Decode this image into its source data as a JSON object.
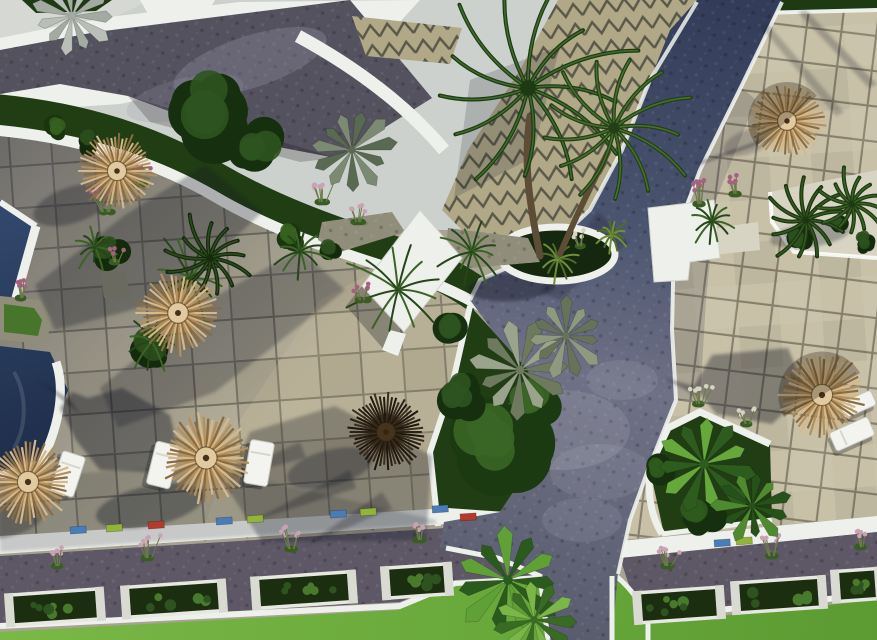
{
  "canvas": {
    "w": 877,
    "h": 640
  },
  "palette": {
    "sky": "#cdd1ce",
    "white": "#eef0ec",
    "paving": "#55525f",
    "zigzag_base": "#b1a888",
    "tile_left": "#b0aa94",
    "tile_right": "#c8c1a8",
    "grout_left": "#4b4840",
    "grout_right": "#5a5444",
    "pool_light": "#33496e",
    "pool_deep": "#1c2b47",
    "lawn_light": "#7ab847",
    "lawn_deep": "#5c9b32",
    "garden": "#203d14",
    "hedge": "#1d3a13",
    "stone": "#908d7a",
    "gravel": "#d7d4c4",
    "trunk": "#5e4d36",
    "path_top": "#333d59",
    "path_mid": "#4a546f",
    "path_junction": "#6f7186",
    "path_low": "#585c6d",
    "walkway": "#5e5866",
    "straw": [
      "#d6b88a",
      "#b3905c",
      "#8a6b40"
    ],
    "straw_center": "#e2c99e",
    "dark_straw": [
      "#2c2214",
      "#1d1710",
      "#3b2d1b"
    ],
    "dark_center": "#45331e",
    "accent_blue": "#4a7db8",
    "accent_lime": "#93b43a",
    "accent_red": "#b53a2e",
    "pink": "#c9a3b4",
    "magenta": "#a85f84",
    "plume": "#d8d4c2",
    "shadow_rgb": "22,25,38"
  },
  "umbrellas": [
    {
      "cx": 117,
      "cy": 171,
      "r": 40,
      "type": "straw"
    },
    {
      "cx": 178,
      "cy": 313,
      "r": 43,
      "type": "straw"
    },
    {
      "cx": 28,
      "cy": 482,
      "r": 44,
      "type": "straw"
    },
    {
      "cx": 206,
      "cy": 458,
      "r": 46,
      "type": "straw"
    },
    {
      "cx": 386,
      "cy": 432,
      "r": 40,
      "type": "dark"
    },
    {
      "cx": 787,
      "cy": 121,
      "r": 39,
      "type": "straw",
      "shade": 140
    },
    {
      "cx": 822,
      "cy": 395,
      "r": 44,
      "type": "straw",
      "shade": 150
    }
  ],
  "umbrella_shadows": [
    {
      "cx": 72,
      "cy": 205,
      "rx": 40,
      "ry": 18,
      "rot": -18,
      "o": 0.32
    },
    {
      "cx": 2,
      "cy": 522,
      "rx": 42,
      "ry": 16,
      "rot": -12,
      "o": 0.32
    },
    {
      "cx": 150,
      "cy": 506,
      "rx": 55,
      "ry": 20,
      "rot": -12,
      "o": 0.38
    },
    {
      "cx": 330,
      "cy": 468,
      "rx": 44,
      "ry": 18,
      "rot": -15,
      "o": 0.33
    },
    {
      "cx": 748,
      "cy": 142,
      "rx": 26,
      "ry": 12,
      "rot": -20,
      "o": 0.22
    },
    {
      "cx": 810,
      "cy": 235,
      "rx": 40,
      "ry": 12,
      "rot": -8,
      "o": 0.3
    },
    {
      "cx": 512,
      "cy": 287,
      "rx": 44,
      "ry": 14,
      "rot": -4,
      "o": 0.42
    }
  ],
  "loungers": [
    {
      "cx": 68,
      "cy": 474,
      "w": 24,
      "h": 42,
      "rot": 18
    },
    {
      "cx": 163,
      "cy": 465,
      "w": 24,
      "h": 44,
      "rot": 14
    },
    {
      "cx": 259,
      "cy": 463,
      "w": 24,
      "h": 44,
      "rot": 10
    },
    {
      "cx": 852,
      "cy": 434,
      "w": 42,
      "h": 20,
      "rot": -24
    },
    {
      "cx": 858,
      "cy": 404,
      "w": 34,
      "h": 16,
      "rot": -24
    }
  ],
  "palms": [
    {
      "type": "pinnate",
      "cx": 528,
      "cy": 88,
      "r": 112,
      "c1": "#3d6b2a",
      "c2": "#1e3a14"
    },
    {
      "type": "pinnate",
      "cx": 614,
      "cy": 128,
      "r": 82,
      "c1": "#466f2e",
      "c2": "#233f16"
    },
    {
      "type": "fan",
      "cx": 520,
      "cy": 370,
      "r": 54,
      "c1": "#9aa48c",
      "c2": "#6d7a5e"
    },
    {
      "type": "fan",
      "cx": 566,
      "cy": 336,
      "r": 44,
      "c1": "#8e9a80",
      "c2": "#66735a"
    },
    {
      "type": "fan",
      "cx": 704,
      "cy": 464,
      "r": 60,
      "c1": "#67a83c",
      "c2": "#2e5c1e"
    },
    {
      "type": "fan",
      "cx": 752,
      "cy": 506,
      "r": 42,
      "c1": "#4f8a30",
      "c2": "#27511b"
    },
    {
      "type": "fan",
      "cx": 508,
      "cy": 580,
      "r": 60,
      "c1": "#5fa136",
      "c2": "#2b5a1d"
    },
    {
      "type": "fan",
      "cx": 534,
      "cy": 620,
      "r": 46,
      "c1": "#7ab648",
      "c2": "#3a6b24"
    },
    {
      "type": "pinnate",
      "cx": 806,
      "cy": 220,
      "r": 44,
      "c1": "#34581f",
      "c2": "#1c3512"
    },
    {
      "type": "pinnate",
      "cx": 852,
      "cy": 204,
      "r": 36,
      "c1": "#3a6024",
      "c2": "#1e3a14"
    },
    {
      "type": "fan",
      "cx": 72,
      "cy": 16,
      "r": 44,
      "c1": "#b9bfb8",
      "c2": "#a2aaa2"
    },
    {
      "type": "fan",
      "cx": 352,
      "cy": 150,
      "r": 46,
      "c1": "#7c8a74",
      "c2": "#5a6a52"
    },
    {
      "type": "pinnate",
      "cx": 210,
      "cy": 258,
      "r": 46,
      "c1": "#2c4c1c",
      "c2": "#16280e"
    }
  ],
  "bushes": [
    {
      "cx": 212,
      "cy": 112,
      "r": 55,
      "c1": "#2e5420",
      "c2": "#16300f"
    },
    {
      "cx": 258,
      "cy": 152,
      "r": 30,
      "c1": "#2e5420",
      "c2": "#16300f"
    },
    {
      "cx": 57,
      "cy": 128,
      "r": 15,
      "c1": "#35611f",
      "c2": "#1a3410"
    },
    {
      "cx": 88,
      "cy": 142,
      "r": 14,
      "c1": "#2b4e1d",
      "c2": "#142a0c"
    },
    {
      "cx": 293,
      "cy": 237,
      "r": 18,
      "c1": "#35611f",
      "c2": "#1a3410"
    },
    {
      "cx": 332,
      "cy": 250,
      "r": 15,
      "c1": "#2b4e1d",
      "c2": "#142a0c"
    },
    {
      "cx": 497,
      "cy": 446,
      "r": 58,
      "c1": "#3a6626",
      "c2": "#1b3a12"
    },
    {
      "cx": 535,
      "cy": 402,
      "r": 36,
      "c1": "#3a6626",
      "c2": "#1b3a12"
    },
    {
      "cx": 462,
      "cy": 398,
      "r": 28,
      "c1": "#2e5420",
      "c2": "#16300f"
    },
    {
      "cx": 452,
      "cy": 330,
      "r": 24,
      "c1": "#2e5420",
      "c2": "#16300f"
    },
    {
      "cx": 800,
      "cy": 240,
      "r": 16,
      "c1": "#2c501f",
      "c2": "#142a0c"
    },
    {
      "cx": 838,
      "cy": 224,
      "r": 14,
      "c1": "#2c501f",
      "c2": "#142a0c"
    },
    {
      "cx": 864,
      "cy": 242,
      "r": 12,
      "c1": "#2c501f",
      "c2": "#142a0c"
    },
    {
      "cx": 660,
      "cy": 470,
      "r": 20,
      "c1": "#2f5a1e",
      "c2": "#16300f"
    },
    {
      "cx": 700,
      "cy": 515,
      "r": 24,
      "c1": "#2f5a1e",
      "c2": "#16300f"
    },
    {
      "cx": 150,
      "cy": 348,
      "r": 26,
      "c1": "#2b4e1d",
      "c2": "#142a0c"
    },
    {
      "cx": 108,
      "cy": 250,
      "r": 20,
      "c1": "#2b4e1d",
      "c2": "#142a0c"
    }
  ],
  "ferns": [
    {
      "cx": 190,
      "cy": 278,
      "r": 52
    },
    {
      "cx": 398,
      "cy": 290,
      "r": 58
    },
    {
      "cx": 300,
      "cy": 252,
      "r": 32
    },
    {
      "cx": 472,
      "cy": 252,
      "r": 38
    },
    {
      "cx": 712,
      "cy": 222,
      "r": 28
    },
    {
      "cx": 152,
      "cy": 342,
      "r": 36
    },
    {
      "cx": 95,
      "cy": 248,
      "r": 26
    },
    {
      "cx": 558,
      "cy": 260,
      "r": 26,
      "c1": "#6f8f3a",
      "c2": "#4e6c28"
    },
    {
      "cx": 612,
      "cy": 236,
      "r": 20,
      "c1": "#6f8f3a",
      "c2": "#4e6c28"
    }
  ],
  "flowers": [
    {
      "cx": 106,
      "cy": 212,
      "n": 9,
      "s": 36,
      "h": 26,
      "c": "magenta"
    },
    {
      "cx": 138,
      "cy": 184,
      "n": 6,
      "s": 26,
      "h": 20,
      "c": "magenta"
    },
    {
      "cx": 322,
      "cy": 202,
      "n": 7,
      "s": 28,
      "h": 22,
      "c": "pink"
    },
    {
      "cx": 358,
      "cy": 222,
      "n": 5,
      "s": 22,
      "h": 18,
      "c": "pink"
    },
    {
      "cx": 700,
      "cy": 204,
      "n": 8,
      "s": 30,
      "h": 24,
      "c": "magenta"
    },
    {
      "cx": 736,
      "cy": 194,
      "n": 5,
      "s": 22,
      "h": 18,
      "c": "magenta"
    },
    {
      "cx": 580,
      "cy": 246,
      "n": 5,
      "s": 20,
      "h": 16,
      "c": "plume"
    },
    {
      "cx": 58,
      "cy": 566,
      "n": 6,
      "s": 26,
      "h": 22,
      "c": "pink"
    },
    {
      "cx": 148,
      "cy": 558,
      "n": 6,
      "s": 26,
      "h": 22,
      "c": "pink"
    },
    {
      "cx": 292,
      "cy": 549,
      "n": 6,
      "s": 26,
      "h": 22,
      "c": "pink"
    },
    {
      "cx": 420,
      "cy": 540,
      "n": 5,
      "s": 22,
      "h": 18,
      "c": "pink"
    },
    {
      "cx": 668,
      "cy": 566,
      "n": 6,
      "s": 24,
      "h": 20,
      "c": "pink"
    },
    {
      "cx": 772,
      "cy": 556,
      "n": 6,
      "s": 24,
      "h": 20,
      "c": "pink"
    },
    {
      "cx": 862,
      "cy": 547,
      "n": 5,
      "s": 22,
      "h": 18,
      "c": "pink"
    },
    {
      "cx": 700,
      "cy": 404,
      "n": 6,
      "s": 26,
      "h": 20,
      "c": "plume"
    },
    {
      "cx": 748,
      "cy": 424,
      "n": 5,
      "s": 22,
      "h": 16,
      "c": "plume"
    },
    {
      "cx": 22,
      "cy": 298,
      "n": 6,
      "s": 22,
      "h": 18,
      "c": "magenta"
    },
    {
      "cx": 116,
      "cy": 262,
      "n": 4,
      "s": 16,
      "h": 14,
      "c": "magenta"
    },
    {
      "cx": 362,
      "cy": 300,
      "n": 5,
      "s": 20,
      "h": 16,
      "c": "magenta"
    }
  ],
  "planter_boxes": {
    "h": 30,
    "rot": -4,
    "left": [
      {
        "x": 12,
        "y": 592,
        "w": 86
      },
      {
        "x": 128,
        "y": 584,
        "w": 92
      },
      {
        "x": 258,
        "y": 575,
        "w": 92
      },
      {
        "x": 388,
        "y": 566,
        "w": 58
      }
    ],
    "right": [
      {
        "x": 640,
        "y": 590,
        "w": 78
      },
      {
        "x": 738,
        "y": 580,
        "w": 82
      },
      {
        "x": 838,
        "y": 570,
        "w": 39
      }
    ]
  },
  "accent_tiles": [
    {
      "x": 70,
      "y": 527,
      "c": "blue"
    },
    {
      "x": 106,
      "y": 525,
      "c": "lime"
    },
    {
      "x": 148,
      "y": 522,
      "c": "red"
    },
    {
      "x": 216,
      "y": 518,
      "c": "blue"
    },
    {
      "x": 247,
      "y": 516,
      "c": "lime"
    },
    {
      "x": 330,
      "y": 511,
      "c": "blue"
    },
    {
      "x": 360,
      "y": 509,
      "c": "lime"
    },
    {
      "x": 432,
      "y": 506,
      "c": "blue"
    },
    {
      "x": 460,
      "y": 514,
      "c": "red"
    },
    {
      "x": 714,
      "y": 540,
      "c": "blue"
    },
    {
      "x": 736,
      "y": 538,
      "c": "lime"
    }
  ]
}
